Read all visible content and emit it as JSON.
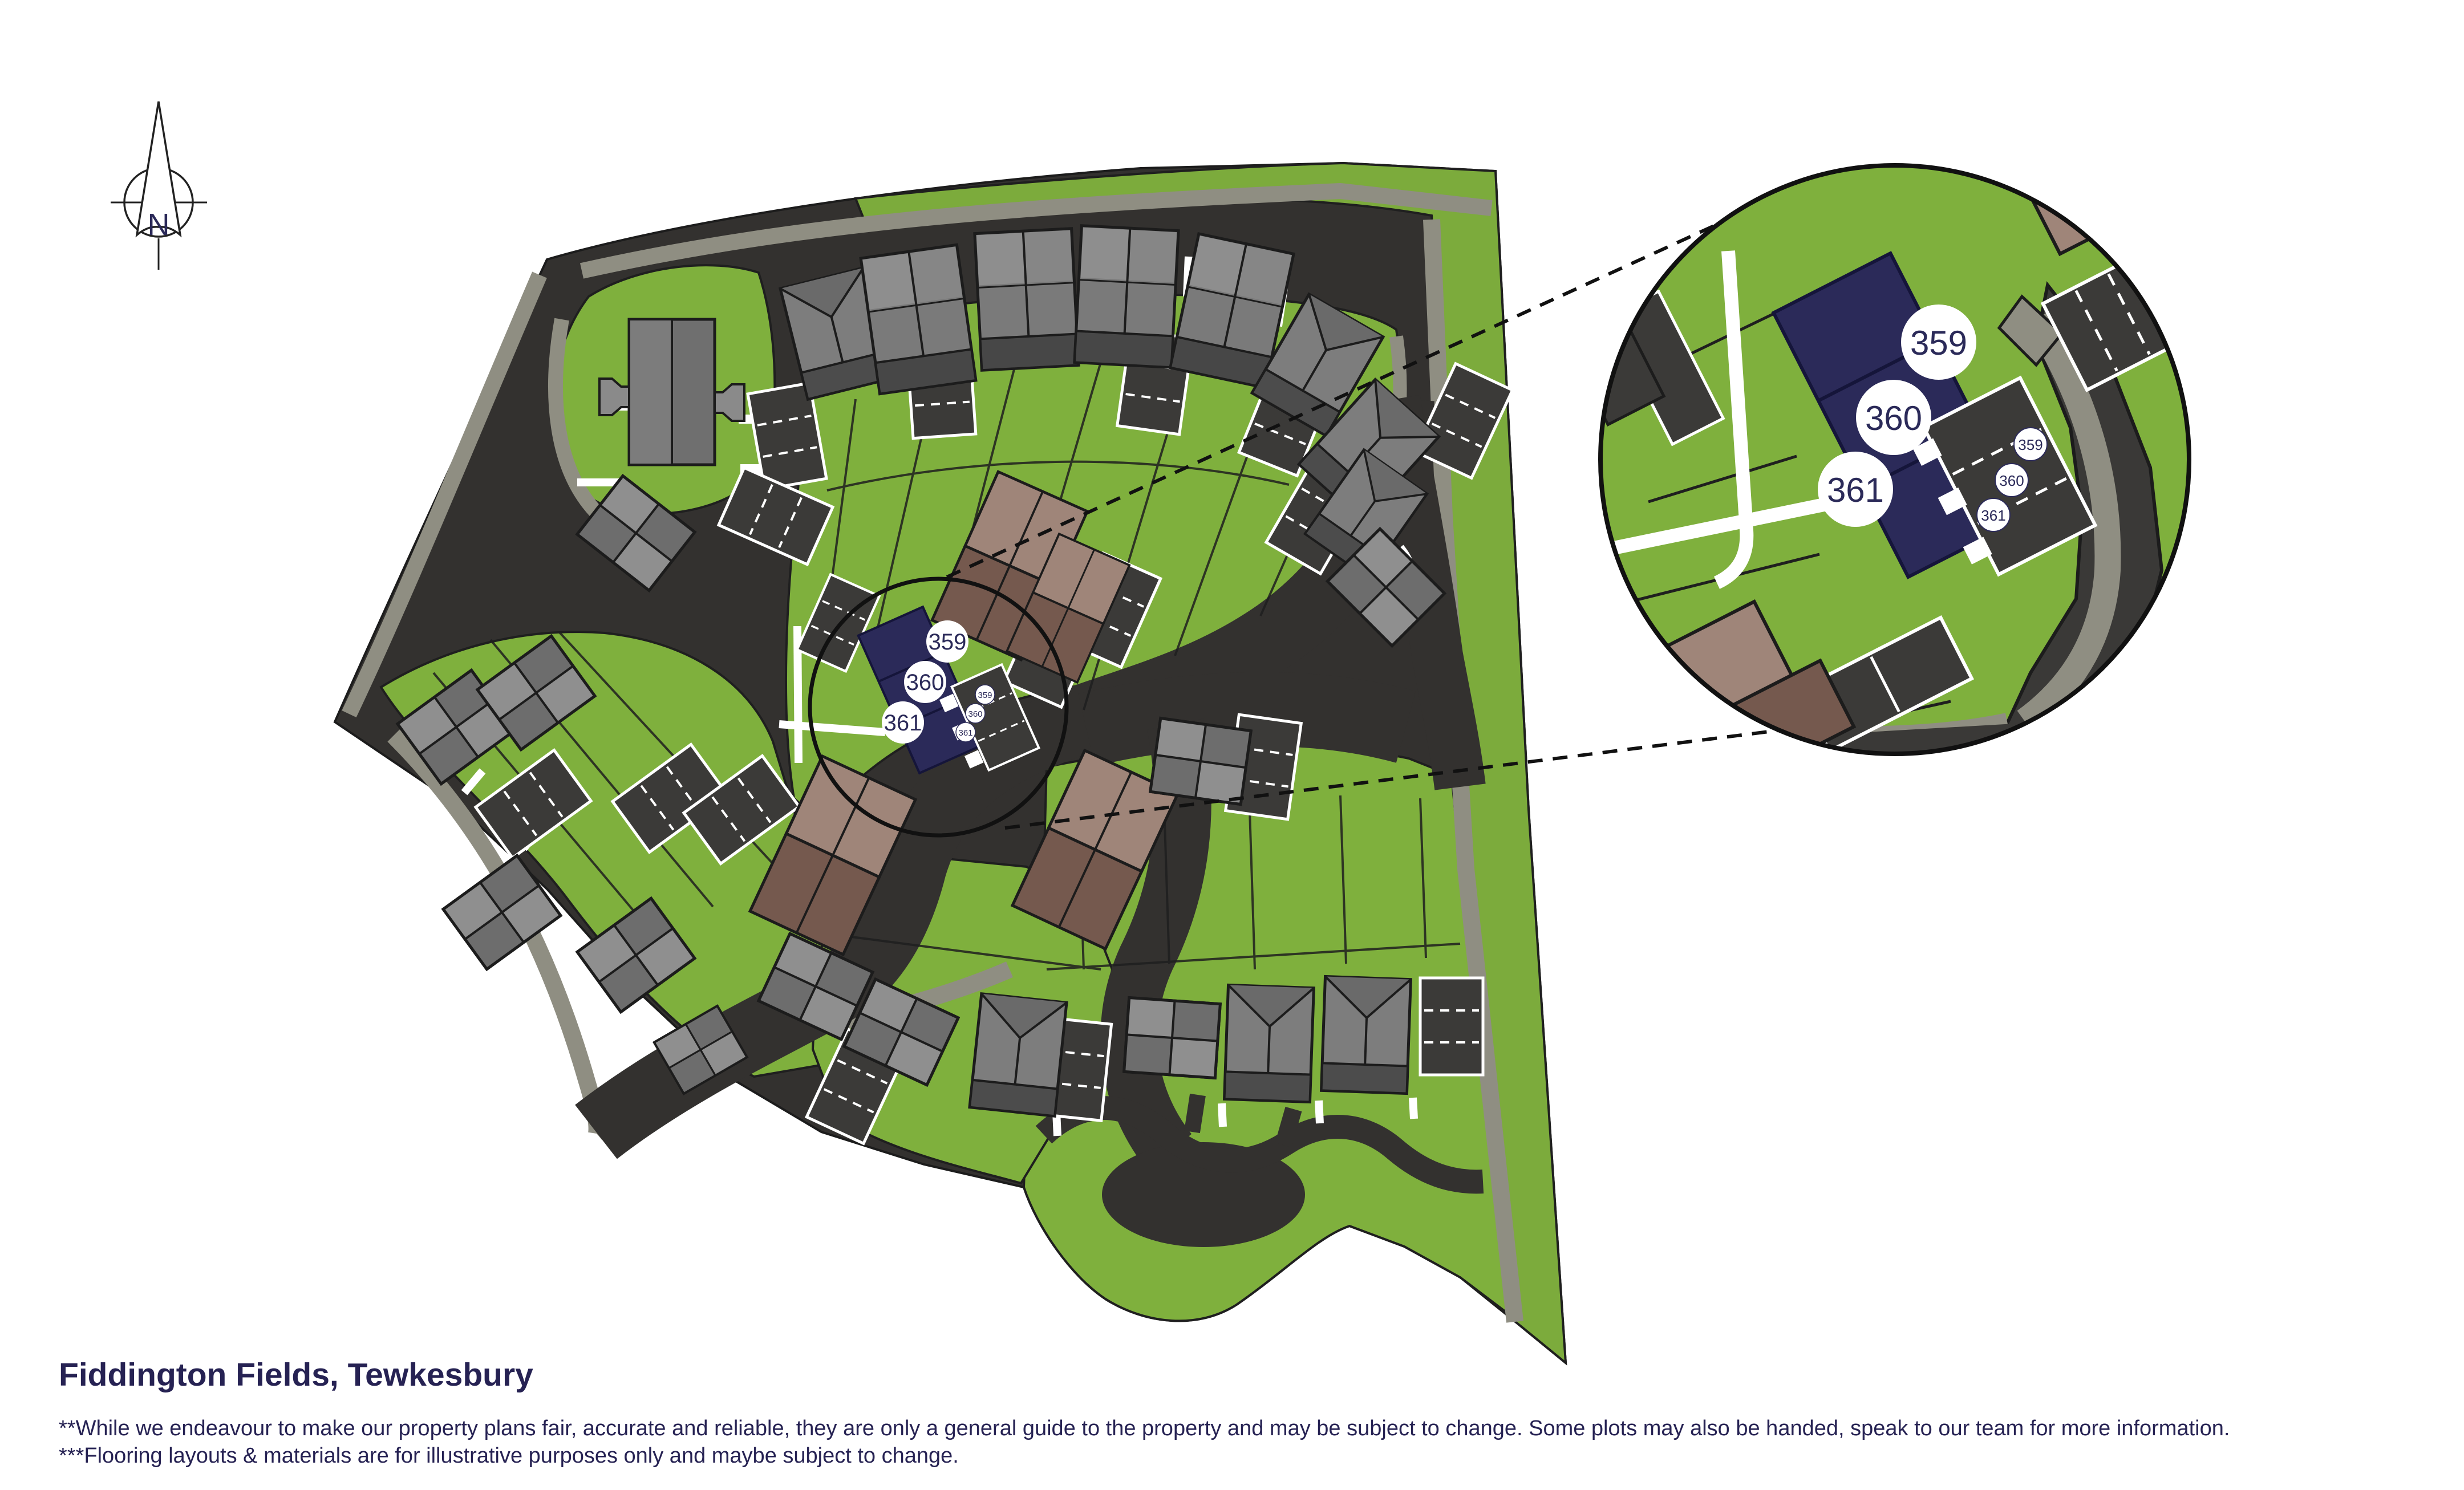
{
  "compass": {
    "label": "N"
  },
  "plots": {
    "numbers": [
      "359",
      "360",
      "361"
    ],
    "parking_numbers": [
      "359",
      "360",
      "361"
    ]
  },
  "inset": {
    "numbers": [
      "359",
      "360",
      "361"
    ],
    "parking_numbers": [
      "359",
      "360",
      "361"
    ]
  },
  "footer": {
    "title": "Fiddington Fields, Tewkesbury",
    "disclaimer_line_1": "**While we endeavour to make our property plans fair, accurate and reliable, they are only a general guide to the property and may be subject to change. Some plots may also be handed, speak to our team for more information.",
    "disclaimer_line_2": "***Flooring layouts & materials are for illustrative purposes only and maybe subject to change."
  },
  "colors": {
    "highlight_navy": "#2b2a59",
    "text_navy": "#262253",
    "grass_green": "#7fb03d",
    "road_dark": "#33312f",
    "pavement_gray": "#8f8e82",
    "roof_gray": "#7a7a7a",
    "roof_brown_light": "#9f8579",
    "roof_brown_dark": "#75594e",
    "parking_dark": "#3b3a38",
    "marker_bg": "#ffffff"
  }
}
